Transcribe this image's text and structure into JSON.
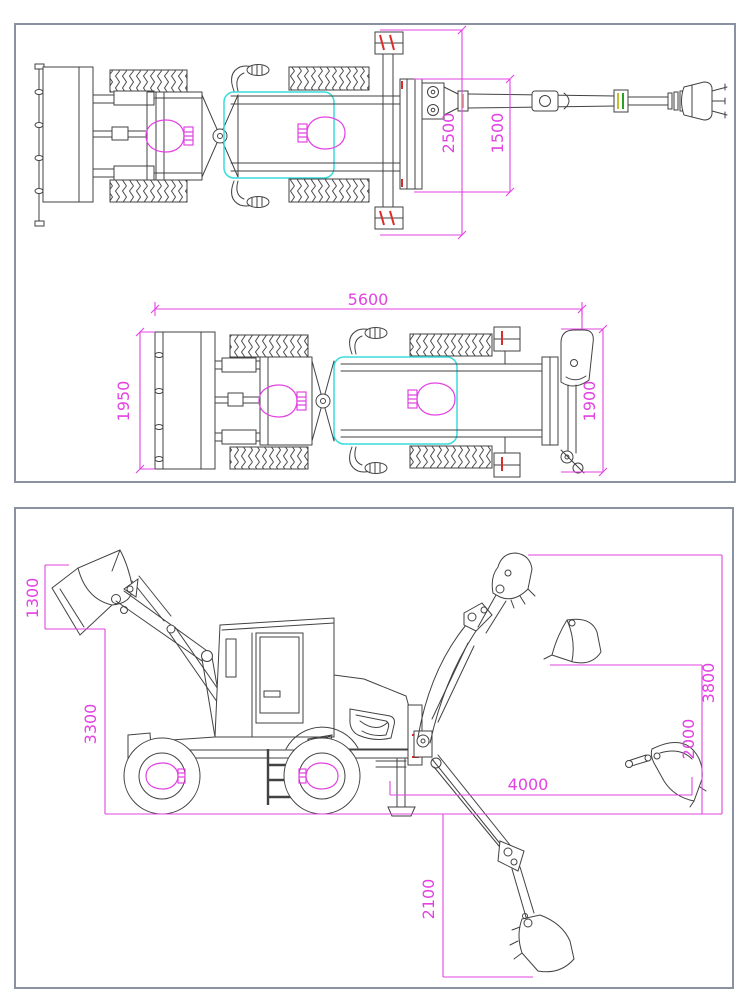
{
  "document": {
    "kind": "engineering-dimension-drawing",
    "subject": "backhoe loader (wheel loader with backhoe attachment)",
    "units": "mm"
  },
  "colors": {
    "line": "#424242",
    "dimension": "#e243e2",
    "highlight": "#38dcdc",
    "accent_red": "#dd2a2a",
    "accent_yellow": "#c2c22e",
    "accent_green": "#2b9e2b",
    "panel_border": "#8a92a2",
    "background": "#ffffff"
  },
  "top_panel": {
    "view_transport": {
      "dim_stabilizer_span": "2500",
      "dim_frame_width": "1500"
    },
    "view_travel": {
      "dim_overall_length": "5600",
      "dim_blade_width": "1950",
      "dim_rear_width": "1900"
    }
  },
  "side_panel": {
    "dim_bucket_opening": "1300",
    "dim_loader_dump_height": "3300",
    "dim_backhoe_max_height": "3800",
    "dim_loading_height": "2000",
    "dim_reach": "4000",
    "dim_digging_depth": "2100"
  }
}
